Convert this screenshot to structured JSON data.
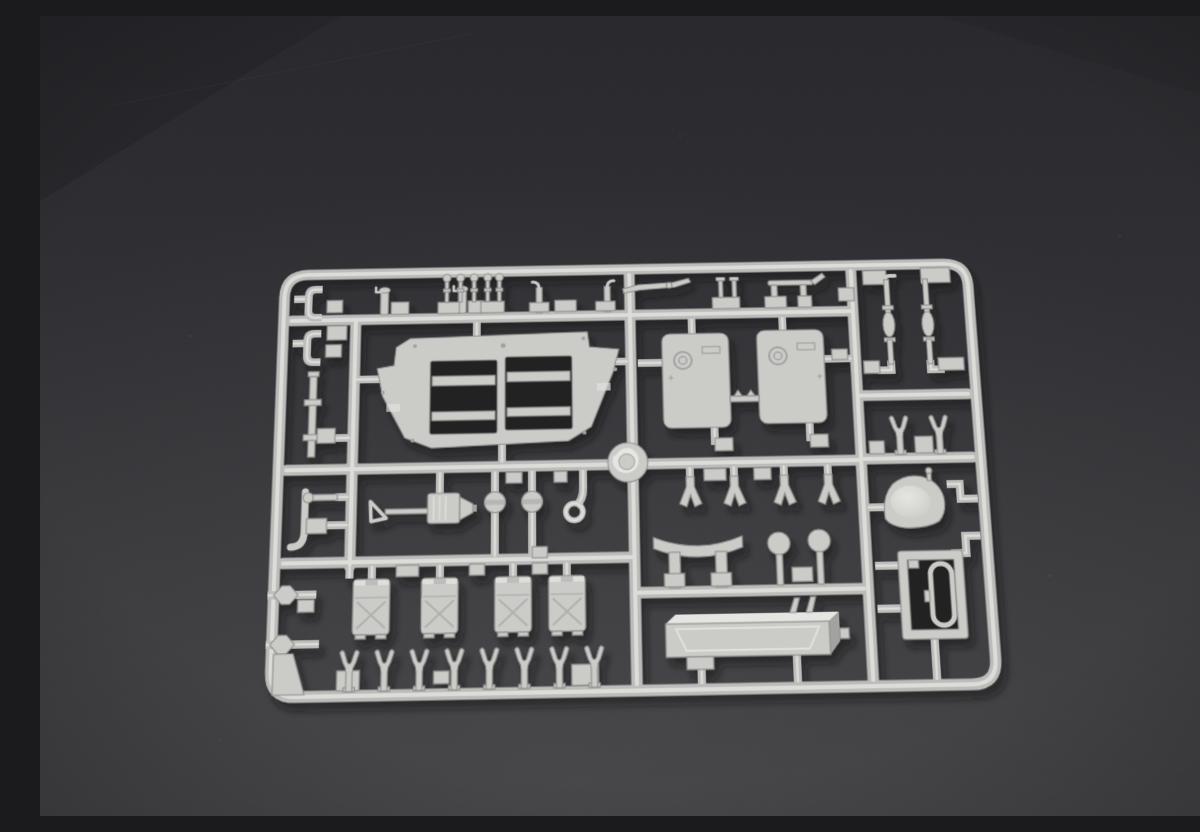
{
  "scene": {
    "description": "Overhead photograph of a light grey injection-moulded plastic model-kit sprue (parts frame) lying on a dark grey studio surface, lit from the upper left with soft shadows below-right of the parts",
    "subject": "plastic model kit sprue with unassembled parts",
    "visible_text": "none",
    "camera": "top-down with slight perspective tilt, sprue rotated about one degree counter-clockwise"
  },
  "sprue": {
    "frame_shape": "rounded rectangle with internal grid of runners",
    "material": "light grey styrene",
    "parts": [
      {
        "id": "hull-bottom-plate",
        "label": "Large trapezoid hull plate with two rectangular hatch openings",
        "count": 1
      },
      {
        "id": "door-hatch",
        "label": "Large rounded rectangular door hatches with ring detail",
        "count": 2
      },
      {
        "id": "stowage-box",
        "label": "Stowage boxes / jerry cans with X bracing",
        "count": 4
      },
      {
        "id": "tow-fork",
        "label": "Two-prong fork fittings",
        "count": 10
      },
      {
        "id": "shackle",
        "label": "Y-shaped shackle fittings",
        "count": 4
      },
      {
        "id": "suspension-rod",
        "label": "Long suspension rods with centre spindle",
        "count": 2
      },
      {
        "id": "dome-hatch",
        "label": "Dome shaped hatch cover",
        "count": 1
      },
      {
        "id": "hatch-frame",
        "label": "Rectangular hatch frame with inner oval ring",
        "count": 1
      },
      {
        "id": "fuel-tank",
        "label": "Long rectangular fuel tank with bevelled face",
        "count": 1
      },
      {
        "id": "curved-bracket",
        "label": "Curved fender bracket on two legs",
        "count": 1
      },
      {
        "id": "light-grille",
        "label": "Round slatted headlight guards on stems",
        "count": 2
      },
      {
        "id": "pump-assembly",
        "label": "Tow-bar / pump assembly with triangular eye and conical nose",
        "count": 1
      },
      {
        "id": "roller",
        "label": "Small grooved rollers",
        "count": 2
      },
      {
        "id": "tow-ring",
        "label": "Small towing ring",
        "count": 1
      },
      {
        "id": "lever-arm",
        "label": "Tapered lever arm with pivot",
        "count": 1
      },
      {
        "id": "handle-bar",
        "label": "Handle bar with upswept end",
        "count": 1
      },
      {
        "id": "mushroom-pin",
        "label": "Mushroom-head pins",
        "count": 5
      },
      {
        "id": "bollard-pin",
        "label": "Capped bollard pins with side spout",
        "count": 2
      },
      {
        "id": "hook-pin",
        "label": "Hook-topped pins",
        "count": 2
      },
      {
        "id": "cap-pin",
        "label": "Flat-cap pins on shared block",
        "count": 2
      },
      {
        "id": "c-clamp",
        "label": "C-shaped clamps",
        "count": 2
      },
      {
        "id": "collared-rod",
        "label": "Vertical rod with collars",
        "count": 1
      },
      {
        "id": "j-pipe",
        "label": "J-shaped pipe",
        "count": 1
      },
      {
        "id": "hex-fitting",
        "label": "Hexagonal inline fittings",
        "count": 2
      },
      {
        "id": "corner-wedge",
        "label": "Corner wedge block",
        "count": 1
      },
      {
        "id": "z-bracket",
        "label": "Z-shaped clips",
        "count": 2
      },
      {
        "id": "sprue-hub",
        "label": "Round moulding hub boss at runner crossing",
        "count": 1
      }
    ]
  },
  "colors": {
    "bg_top": "#26262a",
    "bg_mid": "#2f2f33",
    "bg_bottom": "#3e3e41",
    "bg_glow": "#4b4b4e",
    "hole": "#202023",
    "plastic": "#cbcbc8",
    "plastic_hi": "#e5e5e2",
    "plastic_dk": "#a2a2a0",
    "edge": "#8f8f8d",
    "runner": "#bcbcba",
    "runner_hi": "#dcdcd9",
    "shadow": "#0b0b0d"
  }
}
